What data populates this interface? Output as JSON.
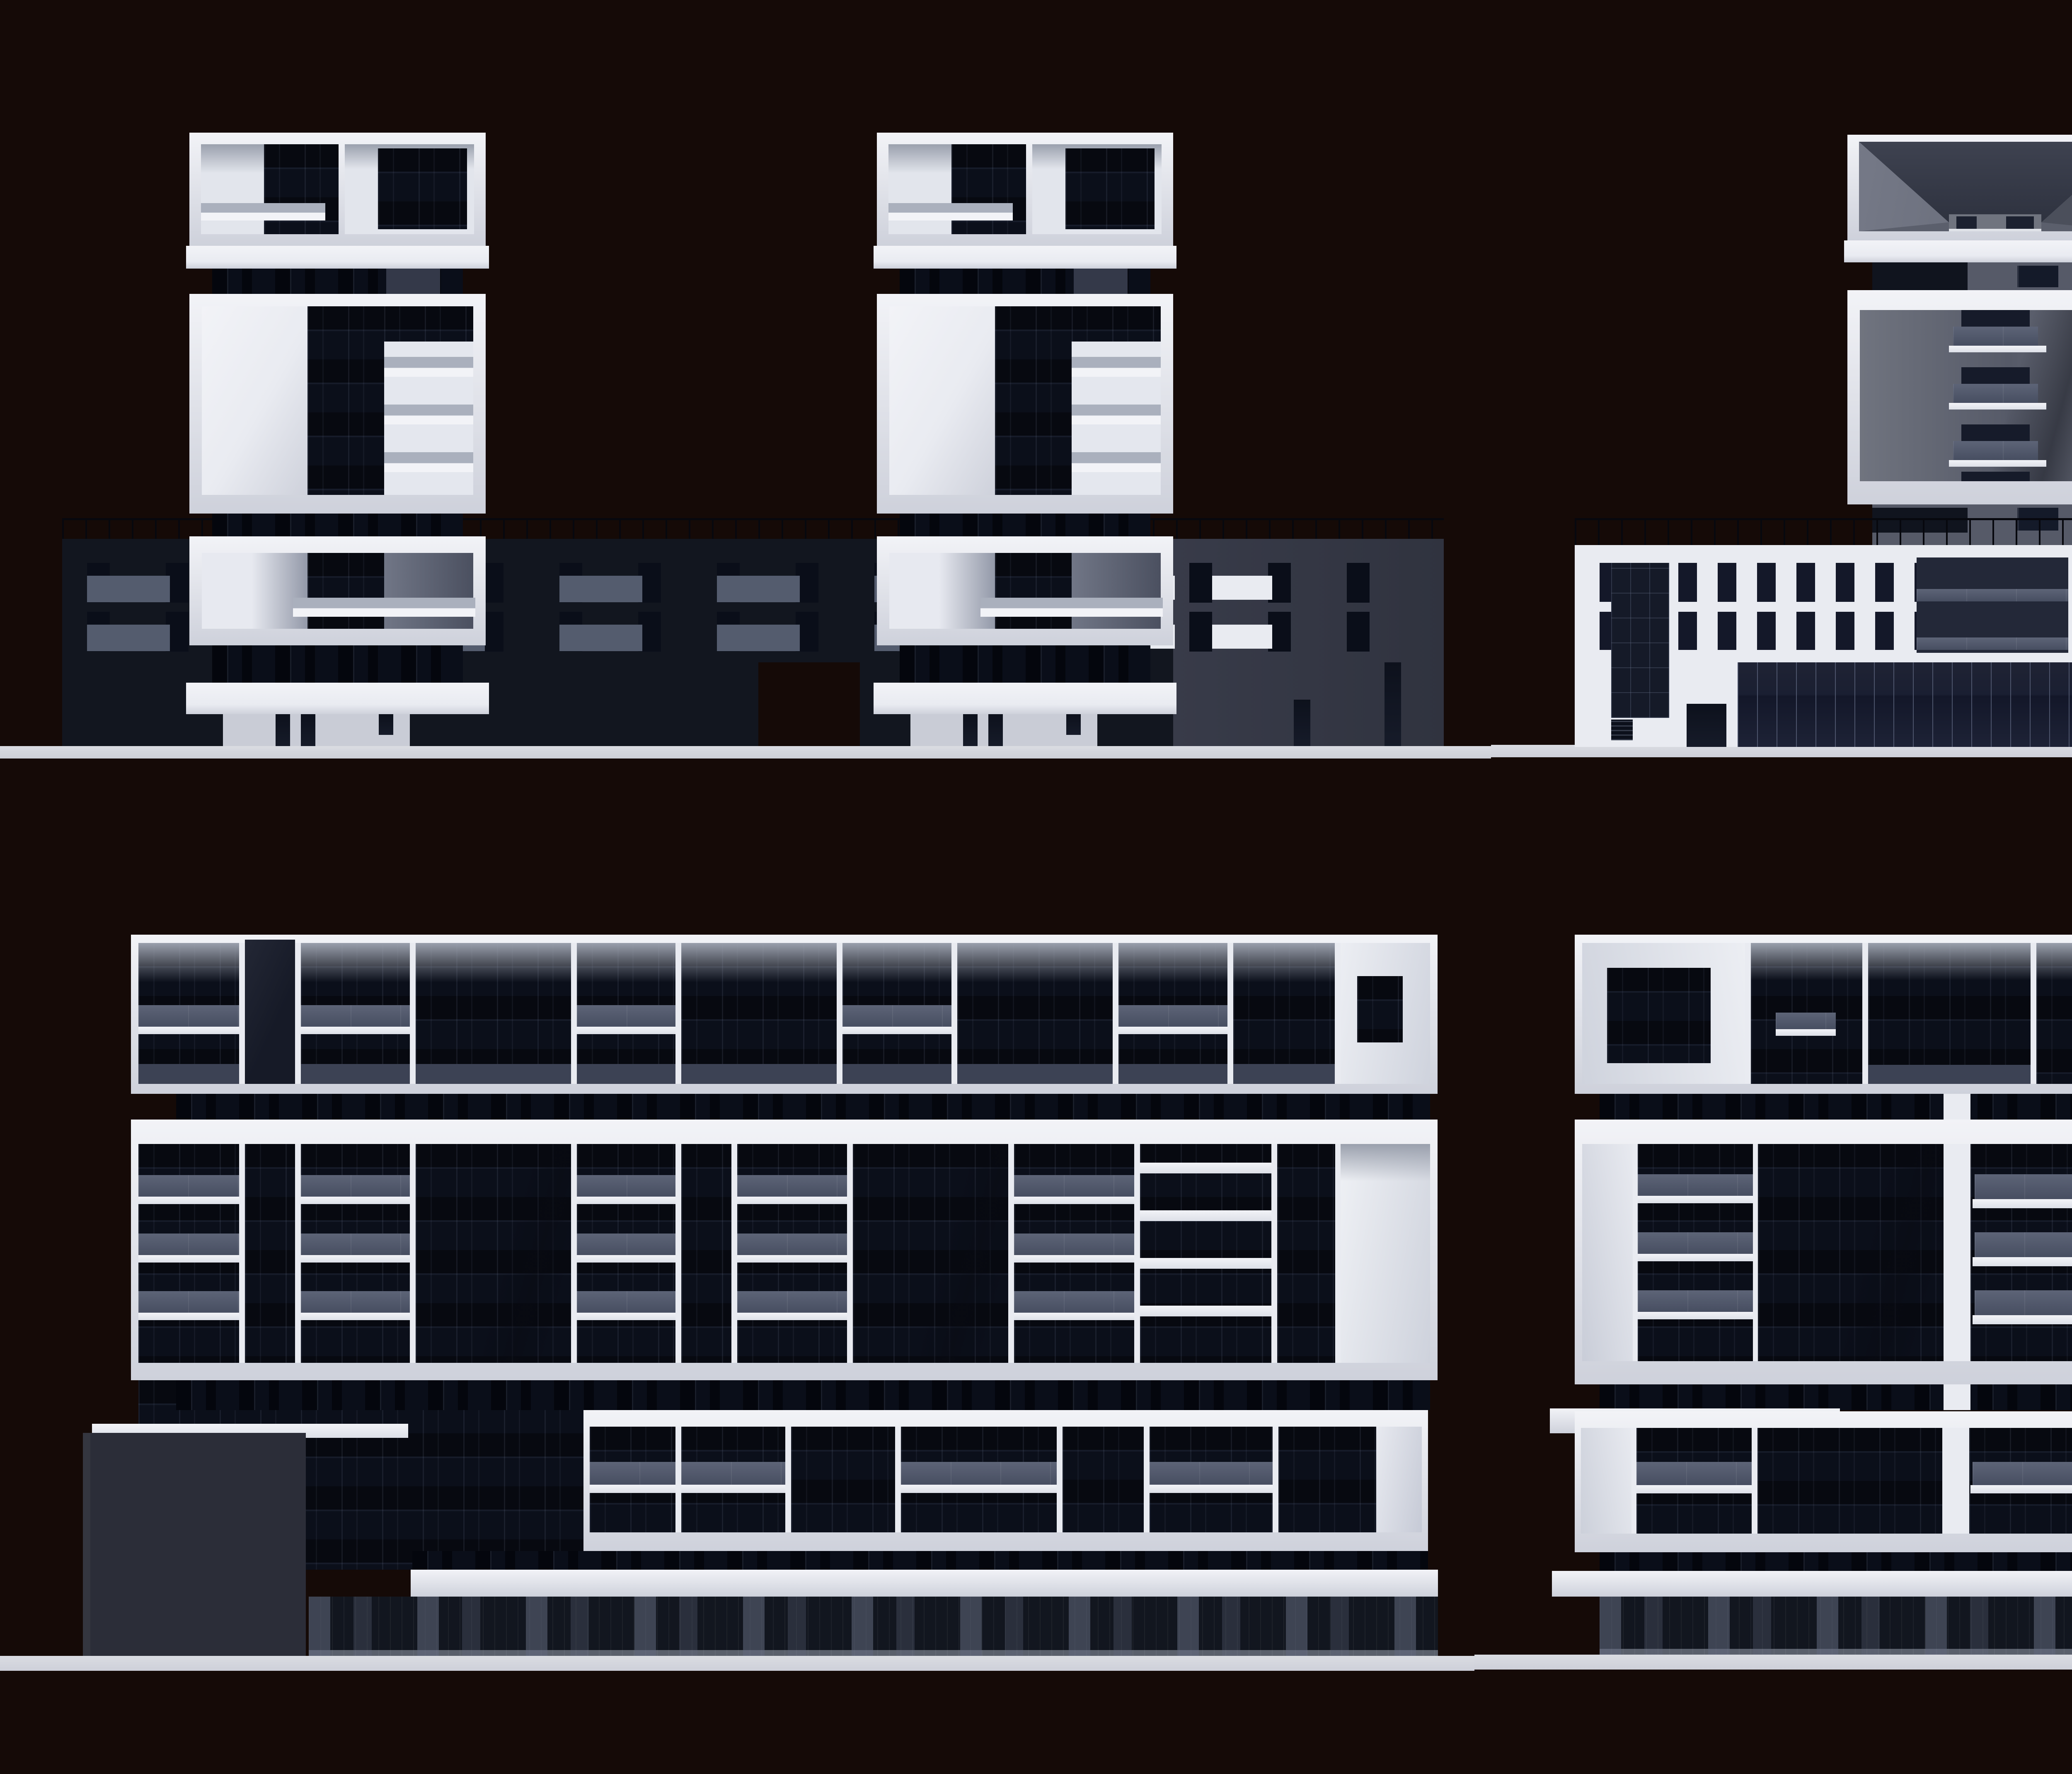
{
  "scene": {
    "kind": "architectural-elevation-render-sheet",
    "description": "Four monochrome 3D building elevation renders arranged on a dark background: twin residential towers on a dark podium (top-left), the same twin towers on a white podium seen from the rear (top-right), and two long perimeter-block facade elevations with stacked white balcony bands (bottom-left and bottom-right).",
    "panels": [
      {
        "id": "tower-pair-front",
        "label": "twin-towers-dark-podium-elevation",
        "position": "top-left"
      },
      {
        "id": "tower-pair-rear",
        "label": "twin-towers-white-podium-elevation",
        "position": "top-right"
      },
      {
        "id": "slab-block-a",
        "label": "perimeter-block-elevation-a",
        "position": "bottom-left"
      },
      {
        "id": "slab-block-b",
        "label": "perimeter-block-elevation-b",
        "position": "bottom-right"
      }
    ]
  },
  "palette": {
    "bg": "#150a07",
    "ground": "#ced0d9",
    "ground-hi": "#dadce2",
    "ground-dark": "#6f6962",
    "white-hi": "#f2f3f7",
    "white": "#e9ebf1",
    "white-lo": "#ced1db",
    "ink": "#0b0f1a",
    "ink2": "#10151f",
    "neck": "#0a0e19",
    "navy": "#12161f",
    "navy-light": "#383b49",
    "glass": "#586070",
    "ceiling": "#9aa0ad",
    "band-blue": "#3c4254",
    "grayface": "#6b6f7c",
    "grayface-dark": "#565a68",
    "towerdark-left": "#2b2d38",
    "towerdark-right": "#3b3d49",
    "slabgray": "#aab0bd"
  }
}
